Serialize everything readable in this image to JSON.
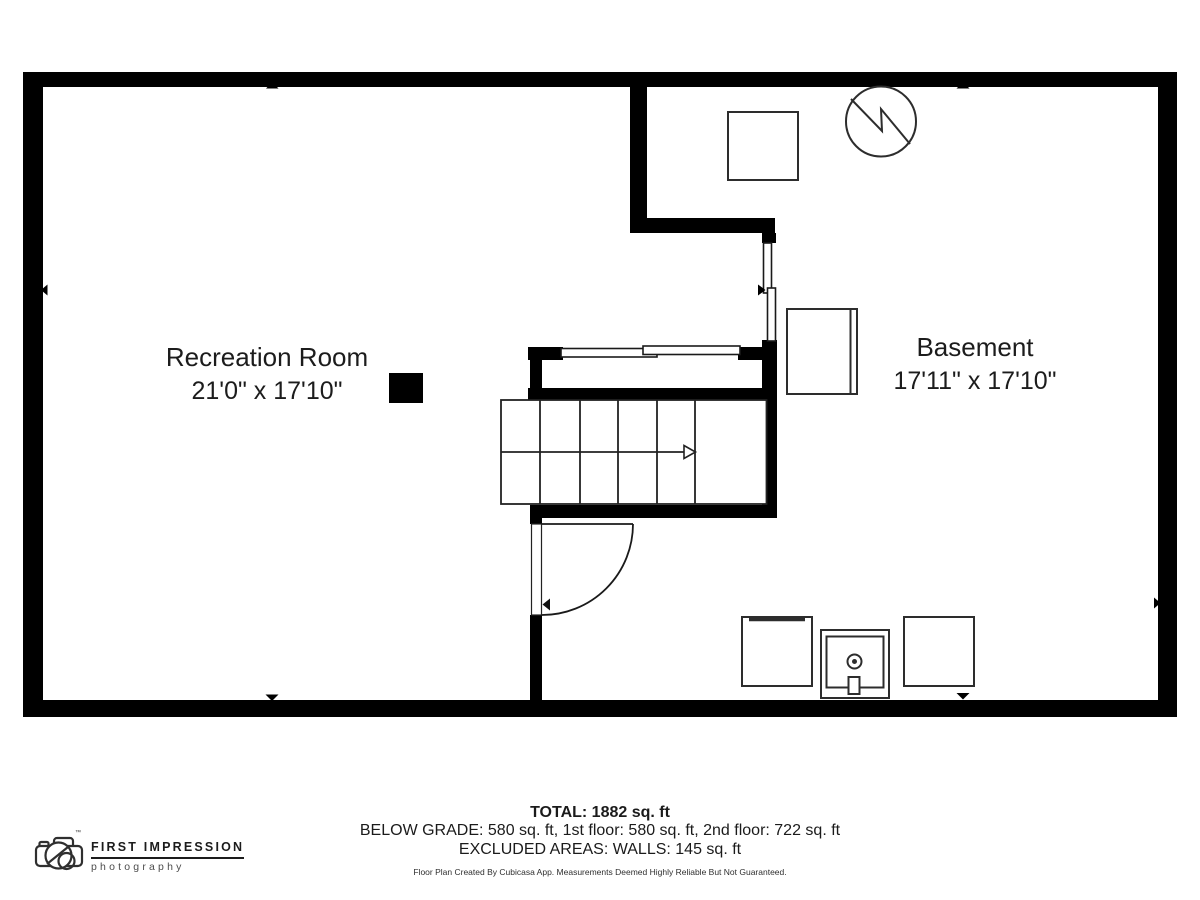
{
  "floor_plan": {
    "rooms": [
      {
        "name": "Recreation Room",
        "dimensions": "21'0\" x 17'10\""
      },
      {
        "name": "Basement",
        "dimensions": "17'11\" x 17'10\""
      }
    ],
    "fixture_icons": [
      "storage-box-icon",
      "water-heater-icon",
      "refrigerator-icon",
      "window-icon",
      "door-swing-icon",
      "staircase-up-arrow-icon",
      "support-column-icon",
      "washer-icon",
      "laundry-sink-icon",
      "dryer-icon",
      "wall-direction-marker-icon"
    ],
    "colors": {
      "walls": "#000000",
      "fixtures": "#2d2d2d",
      "text": "#1c1c1c"
    }
  },
  "summary": {
    "total": "TOTAL: 1882 sq. ft",
    "areas": "BELOW GRADE: 580 sq. ft, 1st floor: 580 sq. ft, 2nd floor: 722 sq. ft",
    "excluded": "EXCLUDED AREAS: WALLS: 145 sq. ft",
    "disclaimer": "Floor Plan Created By Cubicasa App. Measurements Deemed Highly Reliable But Not Guaranteed."
  },
  "branding": {
    "company": "FIRST IMPRESSION",
    "tagline": "photography",
    "trademark": "™"
  }
}
